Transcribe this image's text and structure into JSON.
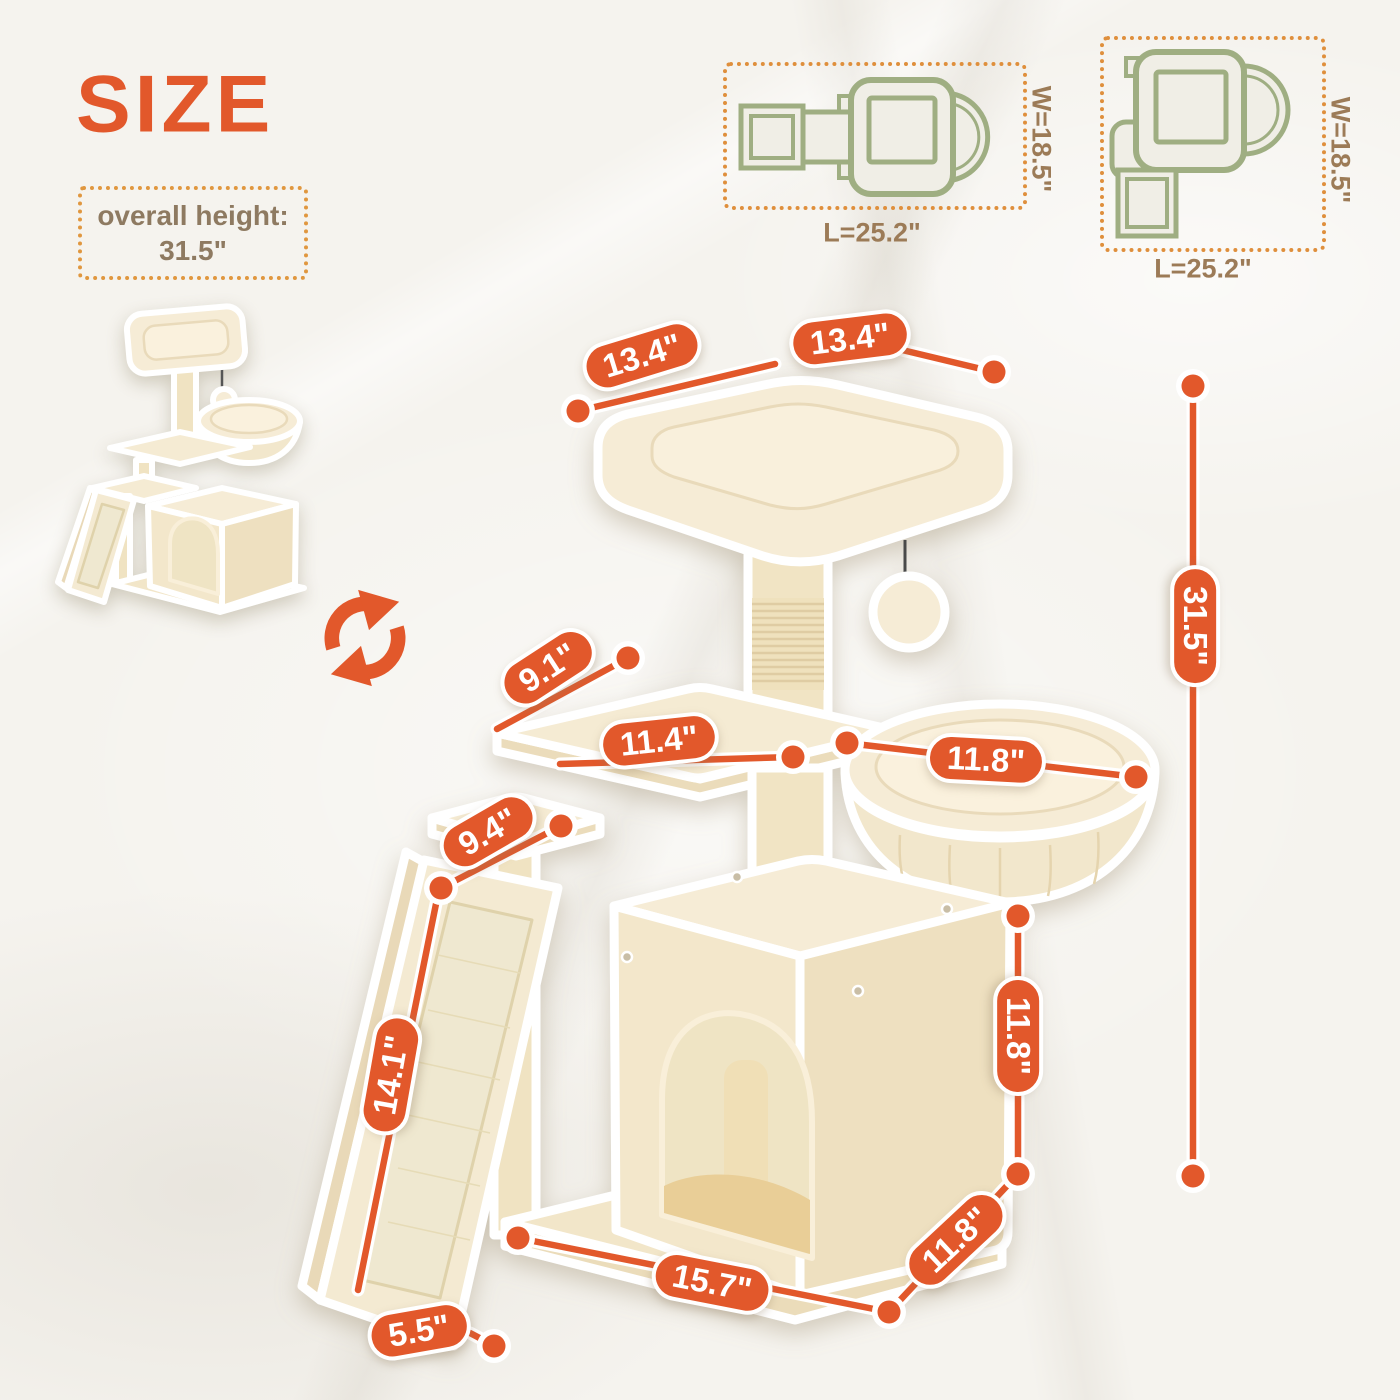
{
  "title": "SIZE",
  "overall_box": {
    "line1": "overall height:",
    "line2": "31.5\""
  },
  "top_views": {
    "side": {
      "width_label": "W=18.5\"",
      "length_label": "L=25.2\""
    },
    "angled": {
      "width_label": "W=18.5\"",
      "length_label": "L=25.2\""
    }
  },
  "dims": {
    "top_width_left": "13.4\"",
    "top_width_right": "13.4\"",
    "platform_depth": "9.1\"",
    "platform_width": "11.4\"",
    "basket_diameter": "11.8\"",
    "ramp_top": "9.4\"",
    "ramp_length": "14.1\"",
    "ramp_width": "5.5\"",
    "base_length": "15.7\"",
    "base_depth": "11.8\"",
    "house_height": "11.8\"",
    "overall_height": "31.5\""
  },
  "colors": {
    "accent_orange": "#E2582B",
    "dotted_orange": "#E0973F",
    "outline_green": "#9FAE82",
    "label_brown": "#9C7B57",
    "plush_cream": "#F5EBD3"
  }
}
